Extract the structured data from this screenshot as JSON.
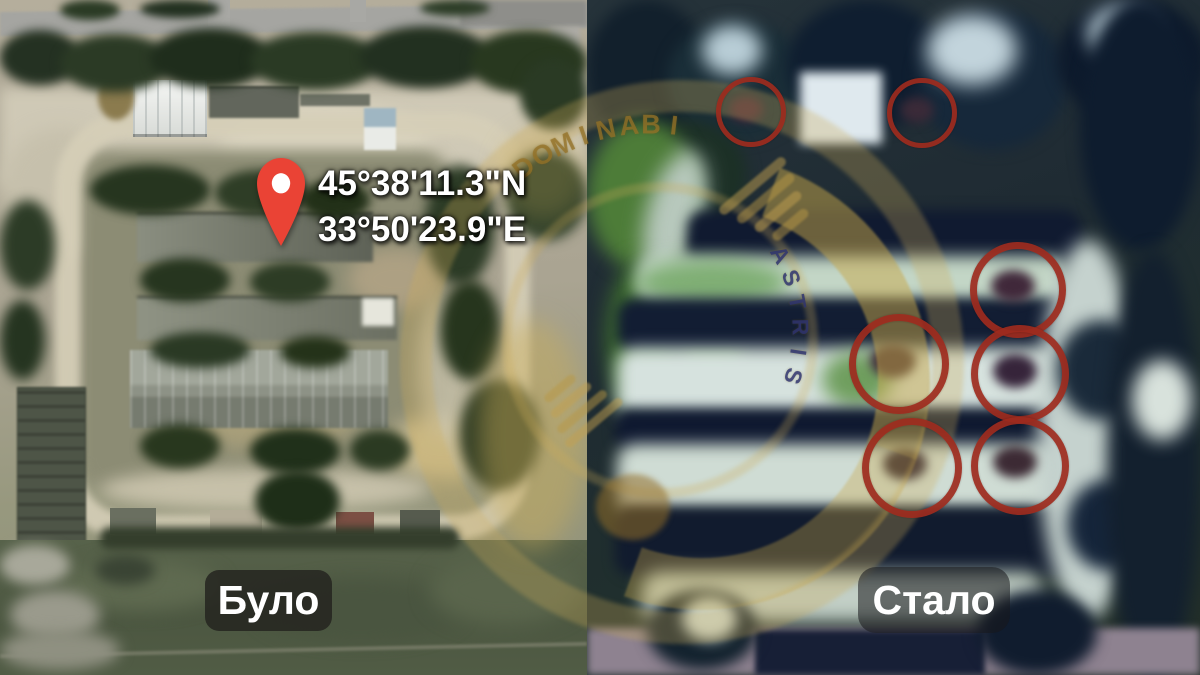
{
  "meta": {
    "description": "Before/after satellite comparison of a military compound",
    "divider_x": 587
  },
  "left_panel": {
    "label": "Було",
    "coordinates": {
      "line1": "45°38'11.3\"N",
      "line2": "33°50'23.9\"E"
    },
    "pin_color": "#EA4335",
    "pin_inner_color": "#FFFFFF"
  },
  "right_panel": {
    "label": "Стало",
    "circle_color": "#9E2B1E",
    "circles": [
      {
        "x": 746,
        "y": 107,
        "r": 30,
        "stroke": 5
      },
      {
        "x": 917,
        "y": 108,
        "r": 30,
        "stroke": 5
      },
      {
        "x": 1011,
        "y": 283,
        "r": 41,
        "stroke": 7
      },
      {
        "x": 892,
        "y": 357,
        "r": 43,
        "stroke": 7
      },
      {
        "x": 1013,
        "y": 367,
        "r": 42,
        "stroke": 7
      },
      {
        "x": 905,
        "y": 461,
        "r": 43,
        "stroke": 7
      },
      {
        "x": 1013,
        "y": 459,
        "r": 42,
        "stroke": 7
      }
    ]
  },
  "watermark": {
    "gold": "#C8A84A",
    "letter_color": "rgba(150,115,40,0.72)",
    "band_letter_color": "rgba(44,50,115,0.8)",
    "arcs": [
      {
        "text": "DOMINABI",
        "cx": 650,
        "cy": 330,
        "r": 205,
        "start": -38,
        "step": 6.4,
        "size": 27,
        "style": "gold"
      },
      {
        "text": "ASTRIS",
        "cx": 650,
        "cy": 330,
        "r": 150,
        "start": 60,
        "step": 9.6,
        "size": 23,
        "style": "navy"
      }
    ]
  }
}
